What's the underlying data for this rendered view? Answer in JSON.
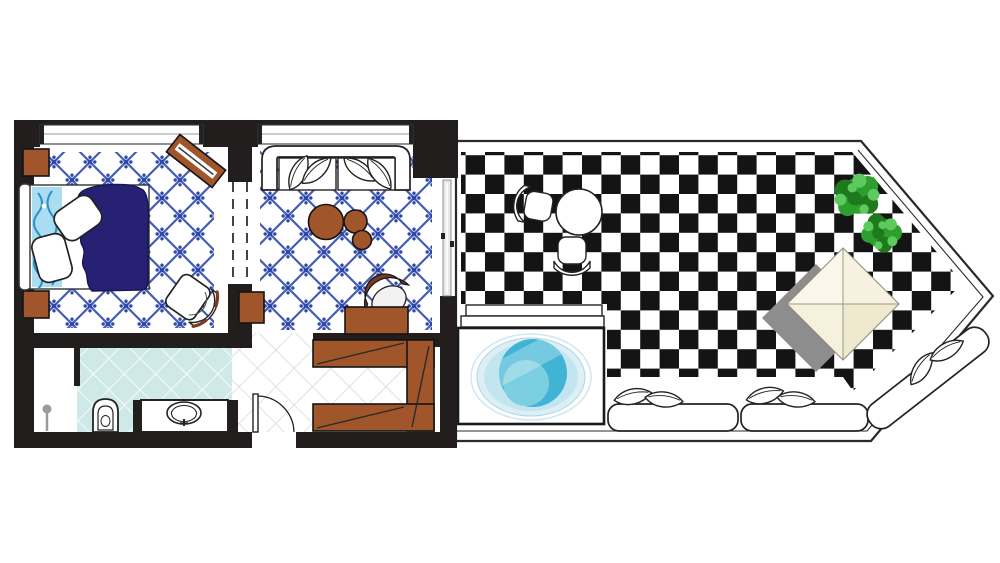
{
  "meta": {
    "type": "floor-plan",
    "description": "Hotel suite floor plan: bedroom and lounge with blue lattice tile floors, bathroom, entry hall with wardrobe, and a private angled terrace with checkerboard paving, plunge pool, bench seating, sun lounger, canopy daybed and plants",
    "text_on_image": ""
  },
  "colors": {
    "wall": "#221e1e",
    "wood": "#a0552a",
    "wood_dark": "#7a3c1e",
    "duvet": "#262173",
    "lattice": "#2f49ab",
    "tile_teal": "#cfe9e8",
    "grid_line": "#d8d8d8",
    "checker": "#141414",
    "pool_rim": "#dceff5",
    "pool_ring": "#c3e5f0",
    "pool_deep": "#41b4d6",
    "pool_light": "#7ccfe0",
    "plant_dark": "#1d7a1d",
    "plant_mid": "#2e9f2e",
    "plant_light": "#5ec95e",
    "canopy": "#f6f1dd",
    "shadow": "#8d8d8d",
    "paisley_bg": "#aadcf2",
    "paisley_line": "#2d8fc4"
  },
  "rooms": {
    "bedroom": {
      "name": "bedroom",
      "floor": "white with blue diagonal lattice and star tiles",
      "furniture": [
        "double bed with navy duvet",
        "headboard",
        "patterned bed runner",
        "pillow",
        "pillow",
        "nightstand",
        "nightstand",
        "wooden luggage bench",
        "armchair"
      ]
    },
    "living_room": {
      "name": "lounge",
      "floor": "white with blue diagonal lattice and star tiles",
      "furniture": [
        "sofa with leaf cushions",
        "round table large",
        "round table medium",
        "round table small",
        "side table",
        "desk",
        "desk chair"
      ]
    },
    "bathroom": {
      "name": "bathroom",
      "floor": "teal diagonal grid tiles with white shower corner",
      "furniture": [
        "shower head",
        "toilet",
        "vanity with oval sink"
      ]
    },
    "hallway": {
      "name": "entry hall",
      "floor": "white with gray diagonal grid",
      "furniture": [
        "entry door with swing arc",
        "built-in wardrobe"
      ]
    },
    "terrace": {
      "name": "terrace",
      "floor": "black and white checkerboard",
      "furniture": [
        "bistro table",
        "terrace chair",
        "terrace chair",
        "plunge pool on deck",
        "deck steps",
        "bench seat with leaf pillows",
        "bench seat with leaf pillows",
        "sun lounger with leaf pillows",
        "potted plant",
        "potted plant",
        "canopy daybed"
      ]
    }
  }
}
